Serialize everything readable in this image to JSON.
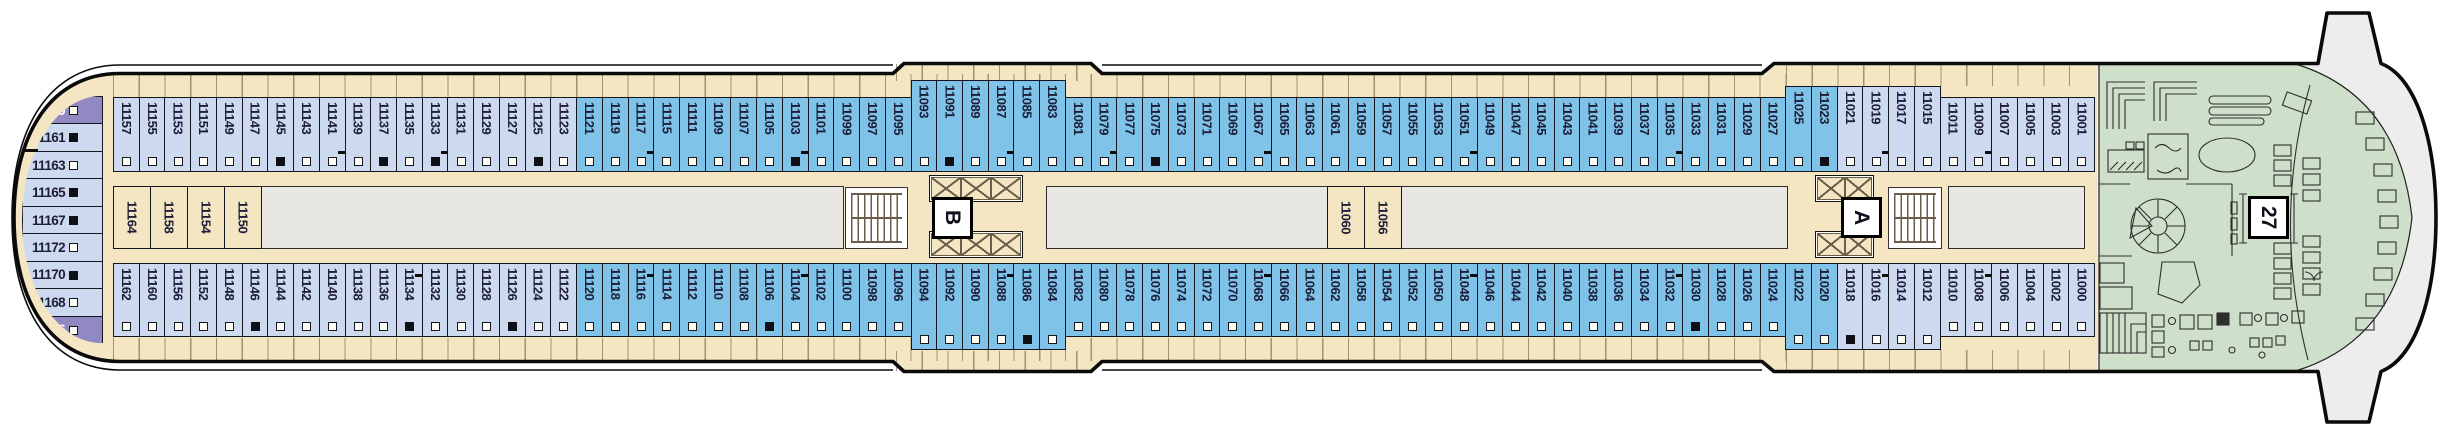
{
  "plan": {
    "stairwell_labels": {
      "aft": "B",
      "forward": "A"
    },
    "bow_area_label": "27"
  },
  "colors": {
    "deck_tan": "#f4e6c2",
    "cabin_light_blue": "#cdd9ee",
    "cabin_blue": "#7fc3e8",
    "cabin_purple": "#9089c2",
    "bow_green": "#cfe0ca",
    "open_space_gray": "#e8e7e4",
    "hull_outline": "#0a0a0a"
  },
  "stern_column": [
    {
      "n": "11159",
      "c": "P",
      "s": "w"
    },
    {
      "n": "11161",
      "c": "L",
      "s": "b",
      "t": true
    },
    {
      "n": "11163",
      "c": "L",
      "s": "w"
    },
    {
      "n": "11165",
      "c": "L",
      "s": "b"
    },
    {
      "n": "11167",
      "c": "L",
      "s": "b"
    },
    {
      "n": "11172",
      "c": "L",
      "s": "w"
    },
    {
      "n": "11170",
      "c": "L",
      "s": "b"
    },
    {
      "n": "11168",
      "c": "L",
      "s": "w"
    },
    {
      "n": "11166",
      "c": "P",
      "s": "w"
    }
  ],
  "mid_cabins_aft": [
    "11164",
    "11158",
    "11154",
    "11150"
  ],
  "mid_cabins_forward": [
    "11060",
    "11056"
  ],
  "top_row": [
    {
      "n": "11157",
      "c": "L",
      "s": "w"
    },
    {
      "n": "11155",
      "c": "L",
      "s": "w"
    },
    {
      "n": "11153",
      "c": "L",
      "s": "w"
    },
    {
      "n": "11151",
      "c": "L",
      "s": "w"
    },
    {
      "n": "11149",
      "c": "L",
      "s": "w"
    },
    {
      "n": "11147",
      "c": "L",
      "s": "w"
    },
    {
      "n": "11145",
      "c": "L",
      "s": "b"
    },
    {
      "n": "11143",
      "c": "L",
      "s": "w"
    },
    {
      "n": "11141",
      "c": "L",
      "s": "w",
      "t": true
    },
    {
      "n": "11139",
      "c": "L",
      "s": "w"
    },
    {
      "n": "11137",
      "c": "L",
      "s": "b"
    },
    {
      "n": "11135",
      "c": "L",
      "s": "w"
    },
    {
      "n": "11133",
      "c": "L",
      "s": "b",
      "t": true
    },
    {
      "n": "11131",
      "c": "L",
      "s": "w"
    },
    {
      "n": "11129",
      "c": "L",
      "s": "w"
    },
    {
      "n": "11127",
      "c": "L",
      "s": "w"
    },
    {
      "n": "11125",
      "c": "L",
      "s": "b"
    },
    {
      "n": "11123",
      "c": "L",
      "s": "w"
    },
    {
      "n": "11121",
      "c": "B",
      "s": "w"
    },
    {
      "n": "11119",
      "c": "B",
      "s": "w"
    },
    {
      "n": "11117",
      "c": "B",
      "s": "w",
      "t": true
    },
    {
      "n": "11115",
      "c": "B",
      "s": "w"
    },
    {
      "n": "11111",
      "c": "B",
      "s": "w"
    },
    {
      "n": "11109",
      "c": "B",
      "s": "w"
    },
    {
      "n": "11107",
      "c": "B",
      "s": "w"
    },
    {
      "n": "11105",
      "c": "B",
      "s": "w"
    },
    {
      "n": "11103",
      "c": "B",
      "s": "b",
      "t": true
    },
    {
      "n": "11101",
      "c": "B",
      "s": "w"
    },
    {
      "n": "11099",
      "c": "B",
      "s": "w"
    },
    {
      "n": "11097",
      "c": "B",
      "s": "w"
    },
    {
      "n": "11095",
      "c": "B",
      "s": "w"
    },
    {
      "n": "11093",
      "c": "B",
      "s": "w"
    },
    {
      "n": "11091",
      "c": "B",
      "s": "b"
    },
    {
      "n": "11089",
      "c": "B",
      "s": "w"
    },
    {
      "n": "11087",
      "c": "B",
      "s": "w",
      "t": true
    },
    {
      "n": "11085",
      "c": "B",
      "s": "w"
    },
    {
      "n": "11083",
      "c": "B",
      "s": "w"
    },
    {
      "n": "11081",
      "c": "B",
      "s": "w"
    },
    {
      "n": "11079",
      "c": "B",
      "s": "w",
      "t": true
    },
    {
      "n": "11077",
      "c": "B",
      "s": "w"
    },
    {
      "n": "11075",
      "c": "B",
      "s": "b"
    },
    {
      "n": "11073",
      "c": "B",
      "s": "w"
    },
    {
      "n": "11071",
      "c": "B",
      "s": "w"
    },
    {
      "n": "11069",
      "c": "B",
      "s": "w"
    },
    {
      "n": "11067",
      "c": "B",
      "s": "w",
      "t": true
    },
    {
      "n": "11065",
      "c": "B",
      "s": "w"
    },
    {
      "n": "11063",
      "c": "B",
      "s": "w"
    },
    {
      "n": "11061",
      "c": "B",
      "s": "w"
    },
    {
      "n": "11059",
      "c": "B",
      "s": "w"
    },
    {
      "n": "11057",
      "c": "B",
      "s": "w"
    },
    {
      "n": "11055",
      "c": "B",
      "s": "w"
    },
    {
      "n": "11053",
      "c": "B",
      "s": "w"
    },
    {
      "n": "11051",
      "c": "B",
      "s": "w",
      "t": true
    },
    {
      "n": "11049",
      "c": "B",
      "s": "w"
    },
    {
      "n": "11047",
      "c": "B",
      "s": "w"
    },
    {
      "n": "11045",
      "c": "B",
      "s": "w"
    },
    {
      "n": "11043",
      "c": "B",
      "s": "w"
    },
    {
      "n": "11041",
      "c": "B",
      "s": "w"
    },
    {
      "n": "11039",
      "c": "B",
      "s": "w"
    },
    {
      "n": "11037",
      "c": "B",
      "s": "w"
    },
    {
      "n": "11035",
      "c": "B",
      "s": "w",
      "t": true
    },
    {
      "n": "11033",
      "c": "B",
      "s": "w"
    },
    {
      "n": "11031",
      "c": "B",
      "s": "w"
    },
    {
      "n": "11029",
      "c": "B",
      "s": "w"
    },
    {
      "n": "11027",
      "c": "B",
      "s": "w"
    },
    {
      "n": "11025",
      "c": "B",
      "s": "w"
    },
    {
      "n": "11023",
      "c": "B",
      "s": "b"
    },
    {
      "n": "11021",
      "c": "L",
      "s": "w"
    },
    {
      "n": "11019",
      "c": "L",
      "s": "w",
      "t": true
    },
    {
      "n": "11017",
      "c": "L",
      "s": "w"
    },
    {
      "n": "11015",
      "c": "L",
      "s": "w"
    },
    {
      "n": "11011",
      "c": "L",
      "s": "w"
    },
    {
      "n": "11009",
      "c": "L",
      "s": "w",
      "t": true
    },
    {
      "n": "11007",
      "c": "L",
      "s": "w"
    },
    {
      "n": "11005",
      "c": "L",
      "s": "w"
    },
    {
      "n": "11003",
      "c": "L",
      "s": "w"
    },
    {
      "n": "11001",
      "c": "L",
      "s": "w"
    }
  ],
  "bottom_row": [
    {
      "n": "11162",
      "c": "L",
      "s": "w"
    },
    {
      "n": "11160",
      "c": "L",
      "s": "w"
    },
    {
      "n": "11156",
      "c": "L",
      "s": "w"
    },
    {
      "n": "11152",
      "c": "L",
      "s": "w"
    },
    {
      "n": "11148",
      "c": "L",
      "s": "w"
    },
    {
      "n": "11146",
      "c": "L",
      "s": "b"
    },
    {
      "n": "11144",
      "c": "L",
      "s": "w"
    },
    {
      "n": "11142",
      "c": "L",
      "s": "w"
    },
    {
      "n": "11140",
      "c": "L",
      "s": "w"
    },
    {
      "n": "11138",
      "c": "L",
      "s": "w"
    },
    {
      "n": "11136",
      "c": "L",
      "s": "w"
    },
    {
      "n": "11134",
      "c": "L",
      "s": "b",
      "t": true
    },
    {
      "n": "11132",
      "c": "L",
      "s": "w"
    },
    {
      "n": "11130",
      "c": "L",
      "s": "w"
    },
    {
      "n": "11128",
      "c": "L",
      "s": "w"
    },
    {
      "n": "11126",
      "c": "L",
      "s": "b"
    },
    {
      "n": "11124",
      "c": "L",
      "s": "w"
    },
    {
      "n": "11122",
      "c": "L",
      "s": "w"
    },
    {
      "n": "11120",
      "c": "B",
      "s": "w"
    },
    {
      "n": "11118",
      "c": "B",
      "s": "w"
    },
    {
      "n": "11116",
      "c": "B",
      "s": "w",
      "t": true
    },
    {
      "n": "11114",
      "c": "B",
      "s": "w"
    },
    {
      "n": "11112",
      "c": "B",
      "s": "w"
    },
    {
      "n": "11110",
      "c": "B",
      "s": "w"
    },
    {
      "n": "11108",
      "c": "B",
      "s": "w"
    },
    {
      "n": "11106",
      "c": "B",
      "s": "b"
    },
    {
      "n": "11104",
      "c": "B",
      "s": "w",
      "t": true
    },
    {
      "n": "11102",
      "c": "B",
      "s": "w"
    },
    {
      "n": "11100",
      "c": "B",
      "s": "w"
    },
    {
      "n": "11098",
      "c": "B",
      "s": "w"
    },
    {
      "n": "11096",
      "c": "B",
      "s": "w"
    },
    {
      "n": "11094",
      "c": "B",
      "s": "w"
    },
    {
      "n": "11092",
      "c": "B",
      "s": "w"
    },
    {
      "n": "11090",
      "c": "B",
      "s": "w"
    },
    {
      "n": "11088",
      "c": "B",
      "s": "w",
      "t": true
    },
    {
      "n": "11086",
      "c": "B",
      "s": "b"
    },
    {
      "n": "11084",
      "c": "B",
      "s": "w"
    },
    {
      "n": "11082",
      "c": "B",
      "s": "w"
    },
    {
      "n": "11080",
      "c": "B",
      "s": "w"
    },
    {
      "n": "11078",
      "c": "B",
      "s": "w"
    },
    {
      "n": "11076",
      "c": "B",
      "s": "w"
    },
    {
      "n": "11074",
      "c": "B",
      "s": "w"
    },
    {
      "n": "11072",
      "c": "B",
      "s": "w"
    },
    {
      "n": "11070",
      "c": "B",
      "s": "w"
    },
    {
      "n": "11068",
      "c": "B",
      "s": "w",
      "t": true
    },
    {
      "n": "11066",
      "c": "B",
      "s": "w"
    },
    {
      "n": "11064",
      "c": "B",
      "s": "w"
    },
    {
      "n": "11062",
      "c": "B",
      "s": "w"
    },
    {
      "n": "11058",
      "c": "B",
      "s": "w"
    },
    {
      "n": "11054",
      "c": "B",
      "s": "w"
    },
    {
      "n": "11052",
      "c": "B",
      "s": "w"
    },
    {
      "n": "11050",
      "c": "B",
      "s": "w"
    },
    {
      "n": "11048",
      "c": "B",
      "s": "w",
      "t": true
    },
    {
      "n": "11046",
      "c": "B",
      "s": "w"
    },
    {
      "n": "11044",
      "c": "B",
      "s": "w"
    },
    {
      "n": "11042",
      "c": "B",
      "s": "w"
    },
    {
      "n": "11040",
      "c": "B",
      "s": "w"
    },
    {
      "n": "11038",
      "c": "B",
      "s": "w"
    },
    {
      "n": "11036",
      "c": "B",
      "s": "w"
    },
    {
      "n": "11034",
      "c": "B",
      "s": "w"
    },
    {
      "n": "11032",
      "c": "B",
      "s": "w",
      "t": true
    },
    {
      "n": "11030",
      "c": "B",
      "s": "b"
    },
    {
      "n": "11028",
      "c": "B",
      "s": "w"
    },
    {
      "n": "11026",
      "c": "B",
      "s": "w"
    },
    {
      "n": "11024",
      "c": "B",
      "s": "w"
    },
    {
      "n": "11022",
      "c": "B",
      "s": "w"
    },
    {
      "n": "11020",
      "c": "B",
      "s": "w"
    },
    {
      "n": "11018",
      "c": "L",
      "s": "b"
    },
    {
      "n": "11016",
      "c": "L",
      "s": "w",
      "t": true
    },
    {
      "n": "11014",
      "c": "L",
      "s": "w"
    },
    {
      "n": "11012",
      "c": "L",
      "s": "w"
    },
    {
      "n": "11010",
      "c": "L",
      "s": "w"
    },
    {
      "n": "11008",
      "c": "L",
      "s": "w",
      "t": true
    },
    {
      "n": "11006",
      "c": "L",
      "s": "w"
    },
    {
      "n": "11004",
      "c": "L",
      "s": "w"
    },
    {
      "n": "11002",
      "c": "L",
      "s": "w"
    },
    {
      "n": "11000",
      "c": "L",
      "s": "w"
    }
  ]
}
